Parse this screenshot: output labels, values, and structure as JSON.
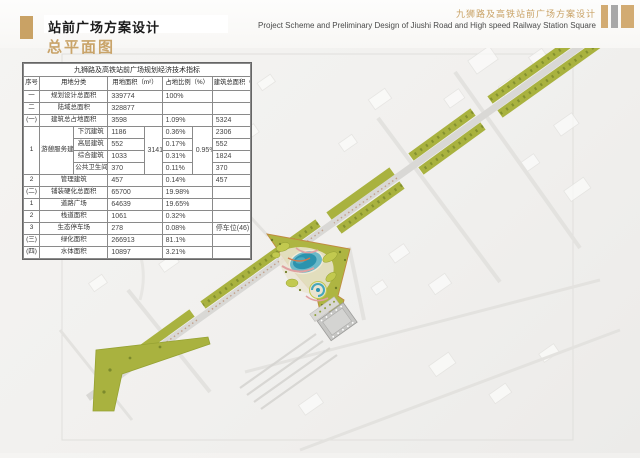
{
  "header": {
    "title": "站前广场方案设计",
    "subtitle": "总平面图",
    "project_cn": "九狮路及高铁站前广场方案设计",
    "project_en": "Project Scheme and Preliminary Design of Jiushi Road and High speed Railway Station Square"
  },
  "palette": {
    "accent_tan": "#c9a265",
    "bar_gray": "#a8a8a8",
    "greenway": "#a9b23f",
    "park_fill": "#aeb542",
    "lake_blue": "#2b93ae"
  },
  "table": {
    "title": "九狮路及高铁站前广场规划经济技术指标",
    "columns": [
      "序号",
      "用地分类",
      "用地面积（m²）",
      "占地比例（%）",
      "建筑总面积（m²）"
    ],
    "rows": {
      "r1": {
        "idx": "一",
        "label": "规划设计总面积",
        "area": "339774",
        "pct": "100%",
        "total": ""
      },
      "r2": {
        "idx": "二",
        "label": "陆域总面积",
        "area": "328877",
        "pct": "",
        "total": ""
      },
      "r3": {
        "idx": "(一)",
        "label": "建筑总占地面积",
        "area": "3598",
        "pct": "1.09%",
        "total": "5324"
      },
      "group": {
        "idx": "1",
        "label": "游憩服务建筑",
        "area_sum": "3141",
        "pct_sum": "0.95%",
        "subs": [
          {
            "label": "下沉建筑",
            "area": "1186",
            "pct": "0.36%",
            "total": "2306"
          },
          {
            "label": "高层建筑",
            "area": "552",
            "pct": "0.17%",
            "total": "552"
          },
          {
            "label": "综合建筑",
            "area": "1033",
            "pct": "0.31%",
            "total": "1824"
          },
          {
            "label": "公共卫生间",
            "area": "370",
            "pct": "0.11%",
            "total": "370"
          }
        ]
      },
      "r8": {
        "idx": "2",
        "label": "管理建筑",
        "area": "457",
        "pct": "0.14%",
        "total": "457"
      },
      "r9": {
        "idx": "(二)",
        "label": "铺装硬化总面积",
        "area": "65700",
        "pct": "19.98%",
        "total": ""
      },
      "r10": {
        "idx": "1",
        "label": "道路广场",
        "area": "64639",
        "pct": "19.65%",
        "total": ""
      },
      "r11": {
        "idx": "2",
        "label": "栈道面积",
        "area": "1061",
        "pct": "0.32%",
        "total": ""
      },
      "r12": {
        "idx": "3",
        "label": "生态停车场",
        "area": "278",
        "pct": "0.08%",
        "total": "停车位(46)"
      },
      "r13": {
        "idx": "(三)",
        "label": "绿化面积",
        "area": "266913",
        "pct": "81.1%",
        "total": ""
      },
      "r14": {
        "idx": "(四)",
        "label": "水体面积",
        "area": "10897",
        "pct": "3.21%",
        "total": ""
      }
    }
  }
}
